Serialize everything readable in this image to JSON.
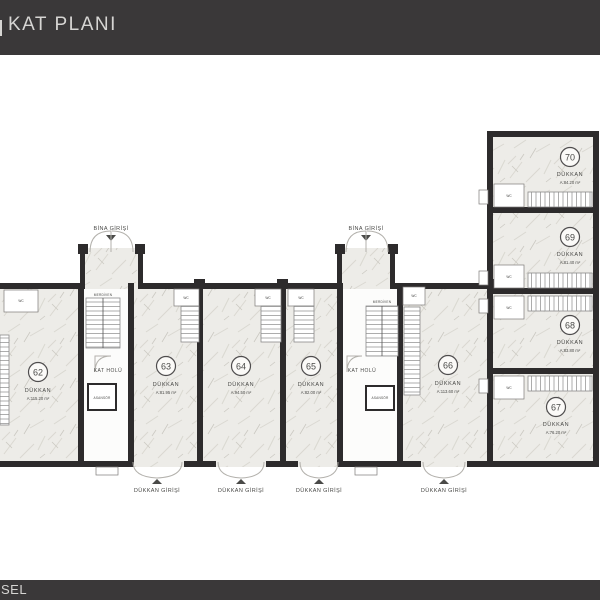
{
  "header": {
    "title": "KAT PLANI"
  },
  "footer": {
    "text": "SEL"
  },
  "colors": {
    "bar": "#3a3839",
    "wall": "#2d2b2c",
    "floor": "#edece8",
    "label": "#4a4a48"
  },
  "plan": {
    "labels": {
      "building_entrance": "BİNA GİRİŞİ",
      "shop_entrance": "DÜKKAN GİRİŞİ",
      "floor_hall": "KAT HOLÜ",
      "elevator": "ASANSÖR",
      "stairs": "MERDİVEN",
      "wc": "WC"
    },
    "shops": [
      {
        "no": "62",
        "type": "DÜKKAN",
        "area": "A:115.20 m²"
      },
      {
        "no": "63",
        "type": "DÜKKAN",
        "area": "A:81.95 m²"
      },
      {
        "no": "64",
        "type": "DÜKKAN",
        "area": "A:94.50 m²"
      },
      {
        "no": "65",
        "type": "DÜKKAN",
        "area": "A:82.00 m²"
      },
      {
        "no": "66",
        "type": "DÜKKAN",
        "area": "A:113.60 m²"
      },
      {
        "no": "67",
        "type": "DÜKKAN",
        "area": "A:76.20 m²"
      },
      {
        "no": "68",
        "type": "DÜKKAN",
        "area": "A:83.80 m²"
      },
      {
        "no": "69",
        "type": "DÜKKAN",
        "area": "A:81.40 m²"
      },
      {
        "no": "70",
        "type": "DÜKKAN",
        "area": "A:84.20 m²"
      }
    ]
  }
}
